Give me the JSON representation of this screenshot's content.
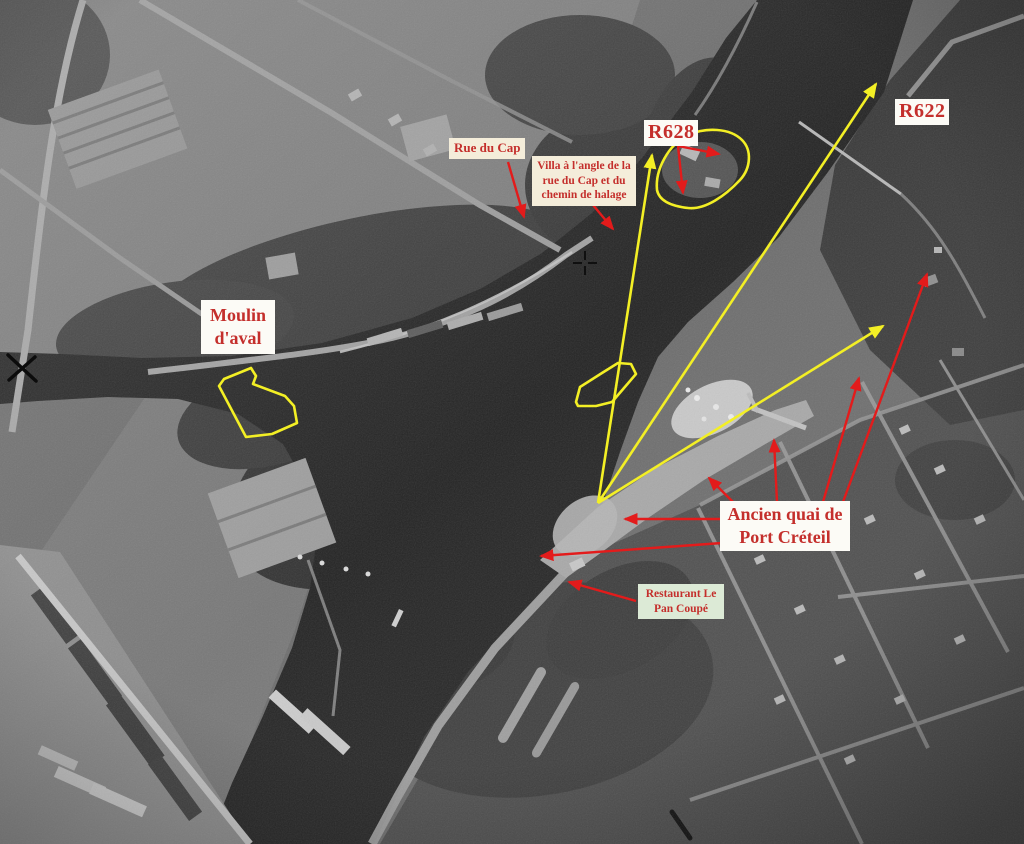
{
  "image_type": "annotated-aerial-photograph",
  "photo": {
    "description": "Black-and-white vertical aerial photo of the Marne river at Port de Créteil with river confluence, towpath, quays, barges and suburb",
    "fiducial_marks": [
      "star-cross-left",
      "crosshair-center"
    ]
  },
  "annotations": {
    "colors": {
      "label_text_red": "#c42f2c",
      "arrow_red": "#e31b1b",
      "arrow_yellow": "#f3ef25",
      "label_bg_cream": "#f4edda",
      "label_bg_white": "#fcfbf6",
      "label_bg_mint": "#dcead6",
      "fiducial_black": "#0c0c0c"
    },
    "labels": {
      "rue_du_cap": {
        "lines": [
          "Rue du Cap"
        ]
      },
      "villa": {
        "lines": [
          "Villa à l'angle de la",
          "rue du Cap et du",
          "chemin de halage"
        ]
      },
      "r628": {
        "lines": [
          "R628"
        ]
      },
      "r622": {
        "lines": [
          "R622"
        ]
      },
      "moulin": {
        "lines": [
          "Moulin",
          "d'aval"
        ]
      },
      "ancien_quai": {
        "lines": [
          "Ancien quai de",
          "Port Créteil"
        ]
      },
      "restaurant": {
        "lines": [
          "Restaurant Le",
          "Pan Coupé"
        ]
      }
    },
    "yellow_outlines": [
      "moulin-daval-site",
      "villa-r628-site",
      "river-barge-site"
    ],
    "yellow_arrows_from_quay_point": 3,
    "red_pointer_arrows": 11
  }
}
